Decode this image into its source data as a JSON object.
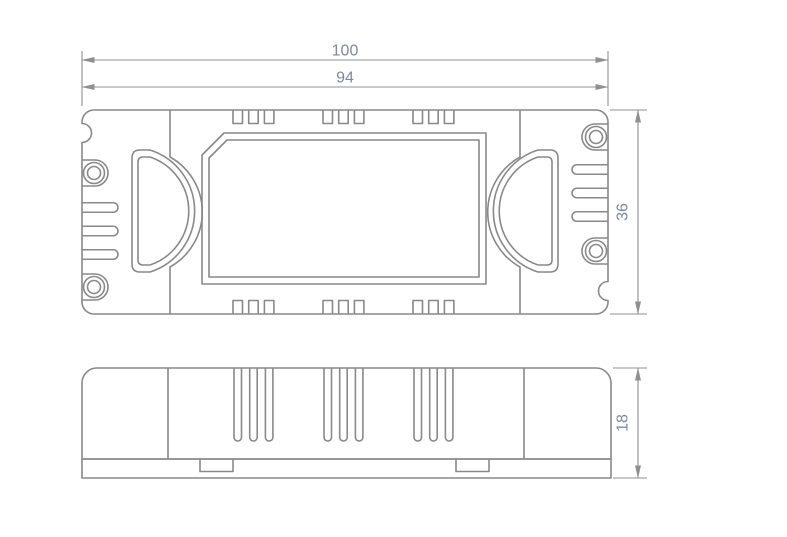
{
  "drawing": {
    "kind": "enclosure-dimension-drawing",
    "views": {
      "top_view_name": "top-view",
      "side_view_name": "side-view"
    }
  },
  "dimensions": {
    "length_outer": "100",
    "length_inner": "94",
    "width": "36",
    "height": "18"
  },
  "colors": {
    "outline": "#898989",
    "dimension_line": "#8f9092",
    "dimension_text": "#7d8a99",
    "background": "#ffffff"
  }
}
